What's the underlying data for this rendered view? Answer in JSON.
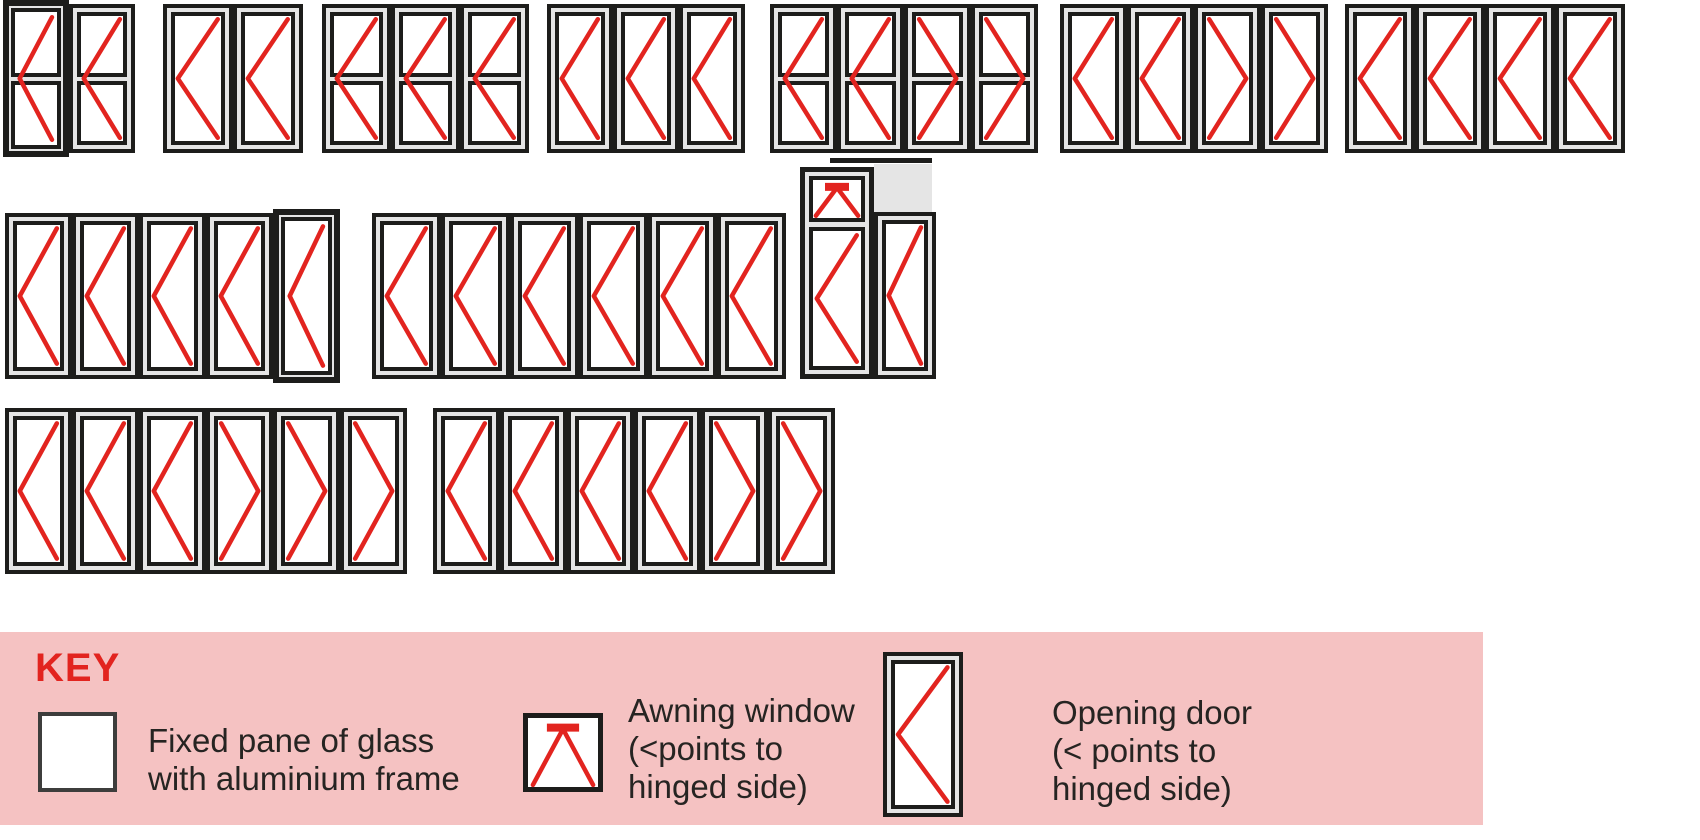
{
  "palette": {
    "red": "#e2241f",
    "pink": "#f5c2c2",
    "frame_black": "#1d1d1b",
    "frame_gray": "#e5e5e5",
    "glass": "#ffffff",
    "text": "#262422",
    "fixed_symbol_border": "#3d3d3c"
  },
  "diagram": {
    "configs": [
      {
        "id": "2-door-midrail-both-left",
        "x": 3,
        "y": 4,
        "pw": 66,
        "ph": 149,
        "midrail": true,
        "dirs": [
          "L",
          "L"
        ],
        "heavy": [
          0
        ]
      },
      {
        "id": "2-door-both-left",
        "x": 163,
        "y": 4,
        "pw": 70,
        "ph": 149,
        "midrail": false,
        "dirs": [
          "L",
          "L"
        ]
      },
      {
        "id": "3-door-midrail-all-left",
        "x": 322,
        "y": 4,
        "pw": 69,
        "ph": 149,
        "midrail": true,
        "dirs": [
          "L",
          "L",
          "L"
        ]
      },
      {
        "id": "3-door-all-left",
        "x": 547,
        "y": 4,
        "pw": 66,
        "ph": 149,
        "midrail": false,
        "dirs": [
          "L",
          "L",
          "L"
        ]
      },
      {
        "id": "4-door-midrail-2-left-2-right",
        "x": 770,
        "y": 4,
        "pw": 67,
        "ph": 149,
        "midrail": true,
        "dirs": [
          "L",
          "L",
          "R",
          "R"
        ]
      },
      {
        "id": "4-door-2-left-2-right",
        "x": 1060,
        "y": 4,
        "pw": 67,
        "ph": 149,
        "midrail": false,
        "dirs": [
          "L",
          "L",
          "R",
          "R"
        ]
      },
      {
        "id": "4-door-all-left",
        "x": 1345,
        "y": 4,
        "pw": 70,
        "ph": 149,
        "midrail": false,
        "dirs": [
          "L",
          "L",
          "L",
          "L"
        ]
      },
      {
        "id": "5-door-all-left",
        "x": 5,
        "y": 213,
        "pw": 67,
        "ph": 166,
        "midrail": false,
        "dirs": [
          "L",
          "L",
          "L",
          "L",
          "L"
        ],
        "heavy": [
          4
        ]
      },
      {
        "id": "6-door-all-left",
        "x": 372,
        "y": 213,
        "pw": 69,
        "ph": 166,
        "midrail": false,
        "dirs": [
          "L",
          "L",
          "L",
          "L",
          "L",
          "L"
        ]
      },
      {
        "id": "6-door-3-left-3-right",
        "x": 5,
        "y": 408,
        "pw": 67,
        "ph": 166,
        "midrail": false,
        "dirs": [
          "L",
          "L",
          "L",
          "R",
          "R",
          "R"
        ]
      },
      {
        "id": "6-door-4-left-2-right",
        "x": 433,
        "y": 408,
        "pw": 67,
        "ph": 166,
        "midrail": false,
        "dirs": [
          "L",
          "L",
          "L",
          "L",
          "R",
          "R"
        ]
      }
    ],
    "awning_unit": {
      "id": "2-door-with-awning-toplight",
      "top_bar": {
        "x": 830,
        "y": 158,
        "w": 102,
        "h": 5
      },
      "left_frame": {
        "x": 800,
        "y": 167,
        "w": 74,
        "h": 212,
        "awning_h": 38
      },
      "right_gray_panel": {
        "x": 874,
        "y": 164,
        "w": 58,
        "h": 48
      },
      "right_door": {
        "x": 874,
        "y": 212,
        "w": 62,
        "h": 167
      }
    }
  },
  "key": {
    "title": "KEY",
    "box": {
      "x": 0,
      "y": 632,
      "w": 1483,
      "h": 193
    },
    "items": [
      {
        "symbol": "fixed-pane-symbol",
        "label_lines": [
          "Fixed pane of glass",
          "with aluminium frame"
        ]
      },
      {
        "symbol": "awning-window-symbol",
        "label_lines": [
          "Awning window",
          "(<points to",
          "hinged side)"
        ]
      },
      {
        "symbol": "opening-door-symbol",
        "label_lines": [
          "Opening door",
          "(< points to",
          "hinged side)"
        ]
      }
    ]
  }
}
